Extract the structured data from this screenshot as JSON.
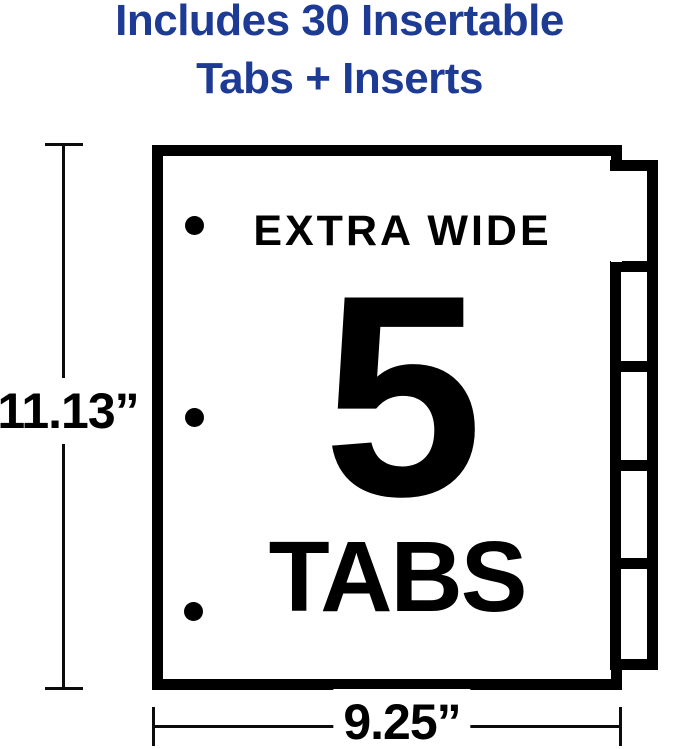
{
  "heading": {
    "line1": "Includes 30 Insertable",
    "line2": "Tabs + Inserts"
  },
  "sheet_labels": {
    "top": "EXTRA WIDE",
    "count": "5",
    "bottom": "TABS"
  },
  "dimensions": {
    "height_label": "11.13”",
    "width_label": "9.25”"
  },
  "diagram": {
    "tab_slots": 5,
    "punch_holes": 3
  },
  "colors": {
    "heading_blue": "#1d3a94",
    "ink": "#000000",
    "background": "#ffffff"
  }
}
